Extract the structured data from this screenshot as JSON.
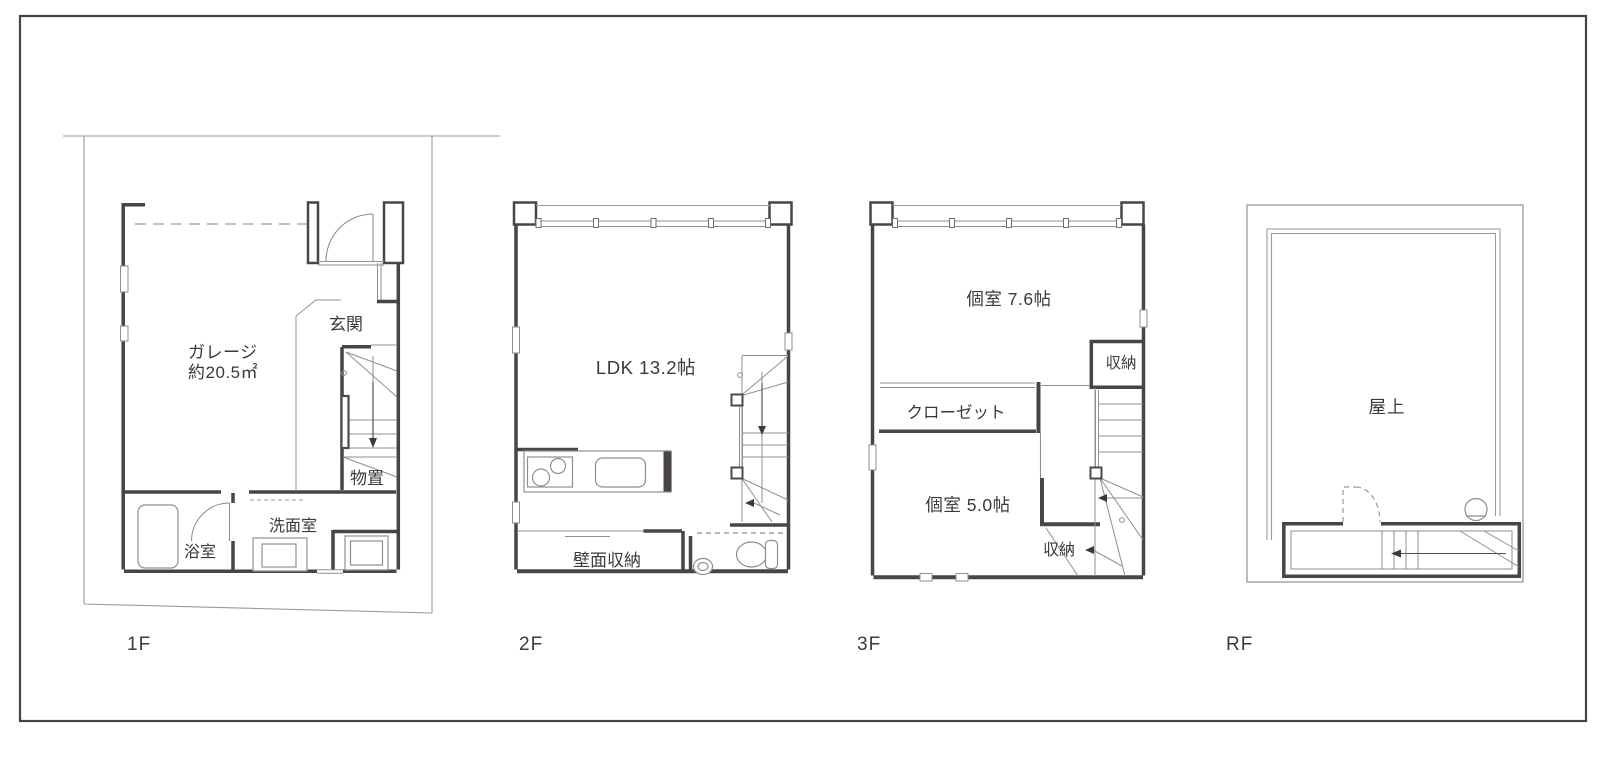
{
  "sheet": {
    "type": "floor-plan-drawing",
    "floor_count": 4
  },
  "colors": {
    "background": "#ffffff",
    "frame_border": "#4a4242",
    "wall": "#4a4444",
    "thin_line": "#8f8f8f",
    "boundary_line": "#9a9a9a",
    "text": "#3d3939"
  },
  "floors": {
    "f1": {
      "label": "1F",
      "rooms": {
        "garage_line1": "ガレージ",
        "garage_line2": "約20.5㎡",
        "entrance": "玄関",
        "storage": "物置",
        "washroom": "洗面室",
        "bathroom": "浴室"
      }
    },
    "f2": {
      "label": "2F",
      "rooms": {
        "ldk": "LDK 13.2帖",
        "wall_storage": "壁面収納"
      }
    },
    "f3": {
      "label": "3F",
      "rooms": {
        "room_a": "個室 7.6帖",
        "storage_a": "収納",
        "closet": "クローゼット",
        "room_b": "個室 5.0帖",
        "storage_b": "収納"
      }
    },
    "rf": {
      "label": "RF",
      "rooms": {
        "rooftop": "屋上"
      }
    }
  }
}
